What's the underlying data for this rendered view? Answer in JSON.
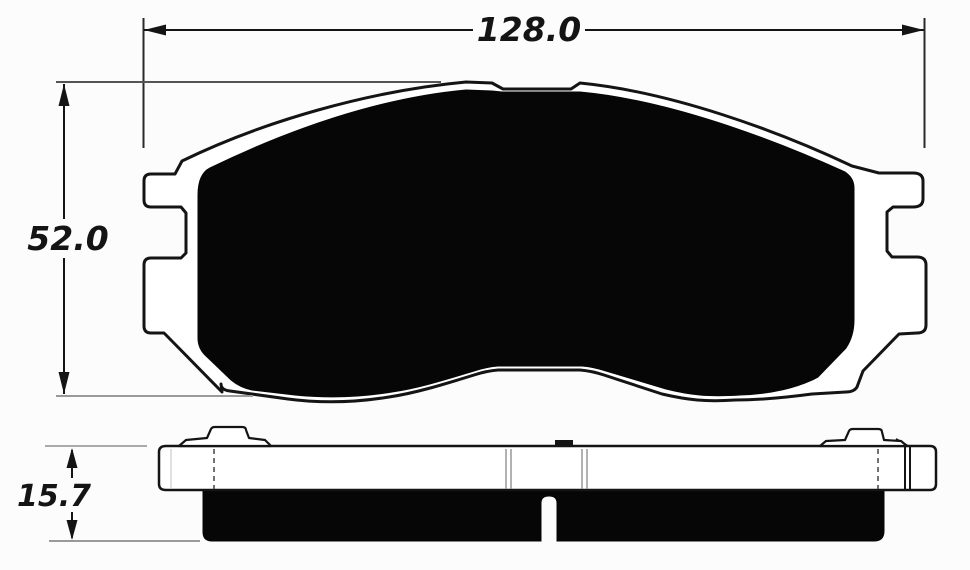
{
  "drawing": {
    "dimension_labels": {
      "width": "128.0",
      "height": "52.0",
      "thickness": "15.7"
    },
    "colors": {
      "line": "#141414",
      "friction_fill": "#060606",
      "extension_line_dark": "#555555",
      "extension_line_light": "#9a9a9a",
      "background": "#fcfcfc"
    }
  }
}
